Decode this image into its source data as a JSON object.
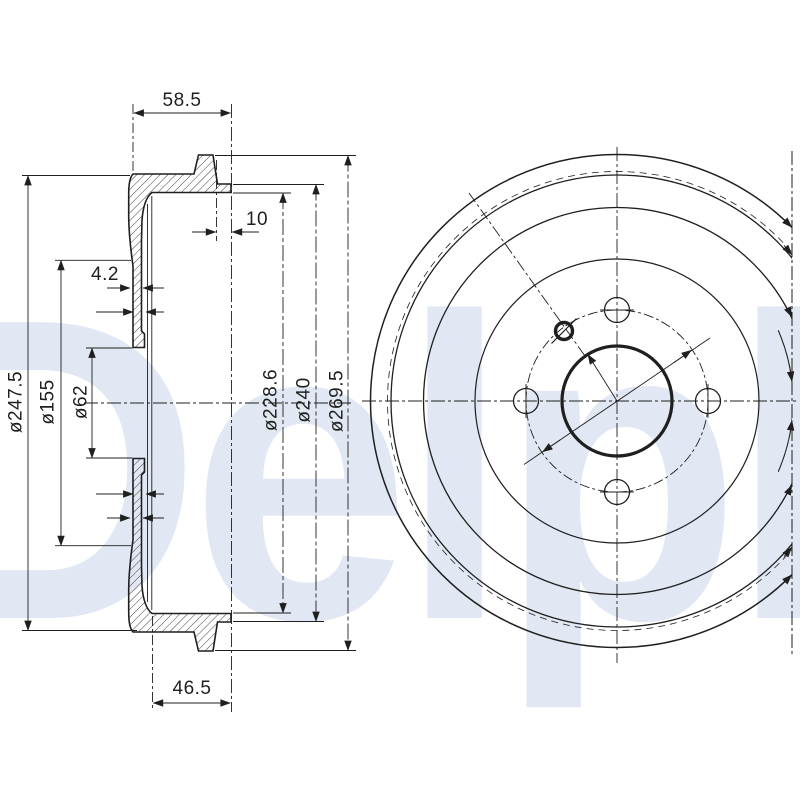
{
  "drawing": {
    "background": "#ffffff",
    "line_color": "#1f1f1f",
    "watermark": {
      "text": "Delphi",
      "color": "#e2e8f3"
    },
    "section_view": {
      "dims": {
        "top_width": "58.5",
        "hub_face_offset": "10",
        "wall_thickness": "4.2",
        "inner_depth": "46.5",
        "dia_flange": "ø247.5",
        "dia_recess": "ø155",
        "dia_bore": "ø62",
        "dia_inner": "ø228.6",
        "dia_lip": "ø240",
        "dia_outer": "ø269.5"
      }
    },
    "front_view": {
      "bolt_holes": 4,
      "locating_holes": 1
    }
  }
}
